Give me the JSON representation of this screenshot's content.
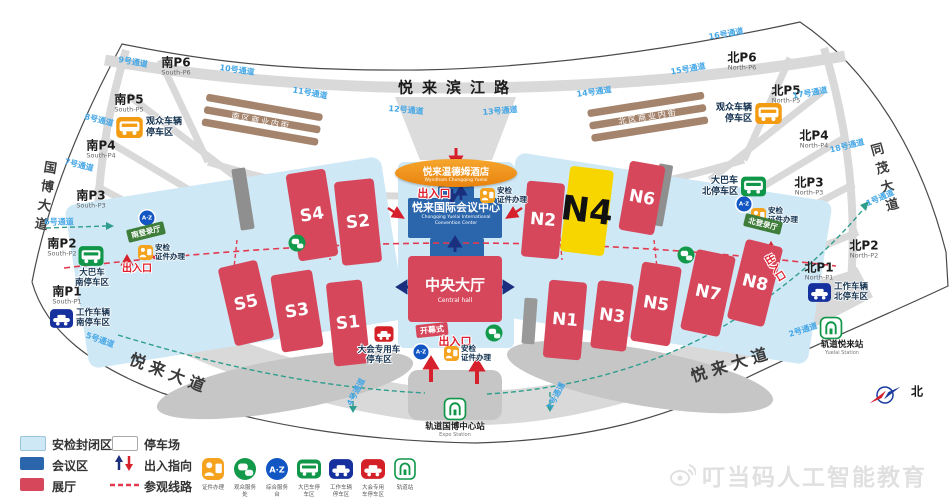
{
  "roads": {
    "binjiang": "悦来滨江路",
    "guobo": "国博大道",
    "tongmao": "同茂大道",
    "yuelai": "悦来大道",
    "north": "北"
  },
  "center": {
    "hotel": "悦来温德姆酒店",
    "hotel_en": "Wyndham Chongqing Yuelai",
    "convention": "悦来国际会议中心",
    "convention_en1": "Chongqing Yuelai International",
    "convention_en2": "Convention Center",
    "central_hall": "中央大厅",
    "central_hall_en": "Central hall",
    "opening": "开幕式"
  },
  "halls": {
    "s1": "S1",
    "s2": "S2",
    "s3": "S3",
    "s4": "S4",
    "s5": "S5",
    "n1": "N1",
    "n2": "N2",
    "n3": "N3",
    "n4": "N4",
    "n5": "N5",
    "n6": "N6",
    "n7": "N7",
    "n8": "N8"
  },
  "parking": {
    "south": [
      {
        "cn": "南P1",
        "en": "South-P1"
      },
      {
        "cn": "南P2",
        "en": "South-P2"
      },
      {
        "cn": "南P3",
        "en": "South-P3"
      },
      {
        "cn": "南P4",
        "en": "South-P4"
      },
      {
        "cn": "南P5",
        "en": "South-P5"
      },
      {
        "cn": "南P6",
        "en": "South-P6"
      }
    ],
    "north": [
      {
        "cn": "北P1",
        "en": "North-P1"
      },
      {
        "cn": "北P2",
        "en": "North-P2"
      },
      {
        "cn": "北P3",
        "en": "North-P3"
      },
      {
        "cn": "北P4",
        "en": "North-P4"
      },
      {
        "cn": "北P5",
        "en": "North-P5"
      },
      {
        "cn": "北P6",
        "en": "North-P6"
      }
    ]
  },
  "areas": {
    "visitor_l1": "观众车辆",
    "visitor_l2": "停车区",
    "bus_s_l1": "大巴车",
    "bus_s_l2": "南停车区",
    "bus_n_l1": "大巴车",
    "bus_n_l2": "北停车区",
    "work_s_l1": "工作车辆",
    "work_s_l2": "南停车区",
    "work_n_l1": "工作车辆",
    "work_n_l2": "北停车区",
    "conf_l1": "大会专用车",
    "conf_l2": "停车区",
    "commercial_s": "南区商业内街",
    "commercial_n": "北区商业内街",
    "reg_s": "南登录厅",
    "reg_n": "北登录厅"
  },
  "labels": {
    "entrance": "出入口",
    "security_l1": "安检",
    "security_l2": "证件办理",
    "az": "A·Z"
  },
  "stations": {
    "expo_cn": "轨道国博中心站",
    "expo_en": "Expo Station",
    "yuelai_cn": "轨道悦来站",
    "yuelai_en": "Yuelai Station"
  },
  "tunnels": {
    "t1": "1号通道",
    "t2": "2号通道",
    "t3": "3号通道",
    "t4": "4号通道",
    "t5": "5号通道",
    "t6": "6号通道",
    "t7": "7号通道",
    "t8": "8号通道",
    "t9": "9号通道",
    "t10": "10号通道",
    "t11": "11号通道",
    "t12": "12号通道",
    "t13": "13号通道",
    "t14": "14号通道",
    "t15": "15号通道",
    "t16": "16号通道",
    "t17": "17号通道",
    "t18": "18号通道"
  },
  "legend": {
    "security_zone": "安检封闭区",
    "parking_lot": "停车场",
    "conference_zone": "会议区",
    "direction": "出入指向",
    "exhibit_hall": "展厅",
    "visit_route": "参观线路",
    "icons": [
      {
        "caption": "证件办理"
      },
      {
        "caption": "观众服务处"
      },
      {
        "caption": "综合服务台"
      },
      {
        "caption": "大巴车停车区"
      },
      {
        "caption": "工作车辆停车区"
      },
      {
        "caption": "大会专用车停车区"
      },
      {
        "caption": "轨道站"
      }
    ]
  },
  "watermark": {
    "text": "叮当码人工智能教育"
  },
  "colors": {
    "hall_red": "#d6475c",
    "n4_yellow": "#f7d600",
    "conference_blue": "#2b66ad",
    "security_lightblue": "#cfe8f6",
    "route_red": "#e23a4e",
    "route_teal": "#2f9e8e",
    "tunnel_blue": "#45a7e6",
    "orange": "#f39c12",
    "bus_green": "#0f9648",
    "work_navy": "#16309e",
    "conf_car_red": "#d42027"
  }
}
